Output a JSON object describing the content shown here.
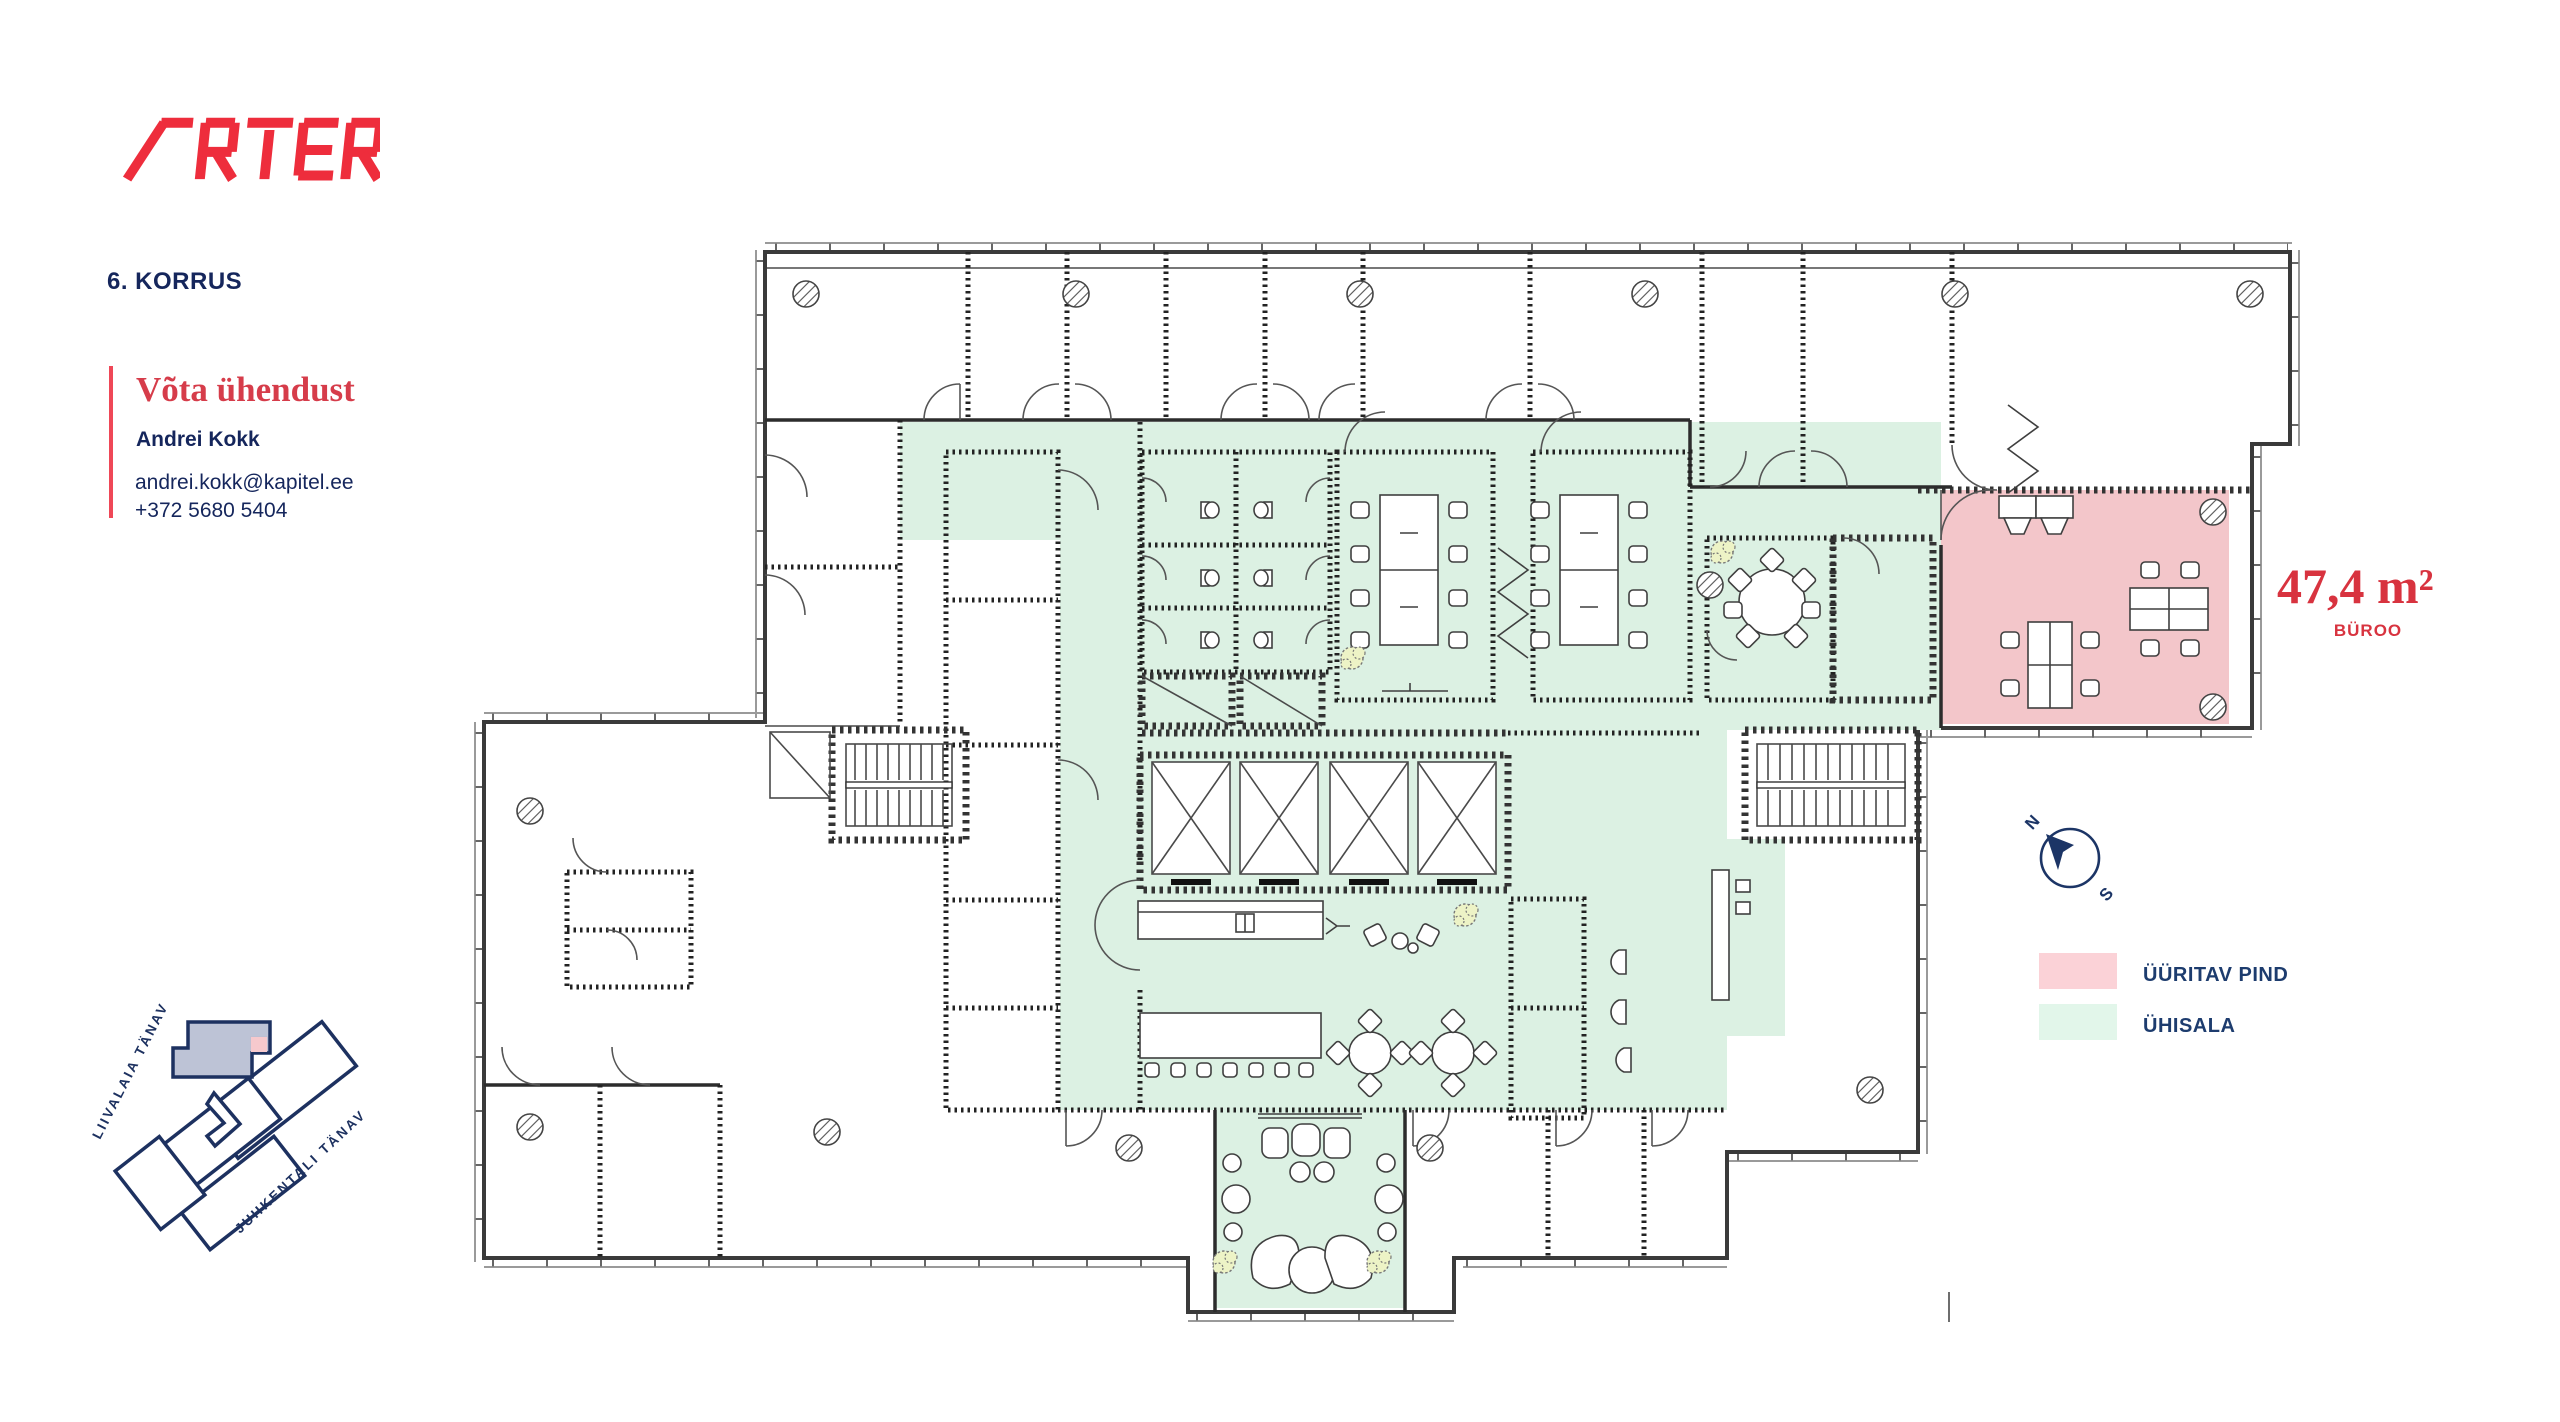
{
  "brand": {
    "logo_text": "ARTER",
    "logo_color": "#ee2d3c"
  },
  "floor": {
    "label": "6. KORRUS"
  },
  "contact": {
    "heading": "Võta ühendust",
    "name": "Andrei Kokk",
    "email": "andrei.kokk@kapitel.ee",
    "phone": "+372 5680 5404"
  },
  "unit": {
    "area": "47,4 m²",
    "type": "BÜROO"
  },
  "legend": {
    "items": [
      {
        "label": "ÜÜRITAV PIND",
        "color": "#fbd2d7"
      },
      {
        "label": "ÜHISALA",
        "color": "#e2f6ea"
      }
    ]
  },
  "compass": {
    "north": "N",
    "south": "S"
  },
  "map": {
    "streets": [
      "LIIVALAIA TÄNAV",
      "JUHKENTALI TÄNAV"
    ]
  },
  "plan": {
    "colors": {
      "rentable": "#f3c6ca",
      "common": "#dcf1e3",
      "walls": "#2c2c2c"
    }
  }
}
